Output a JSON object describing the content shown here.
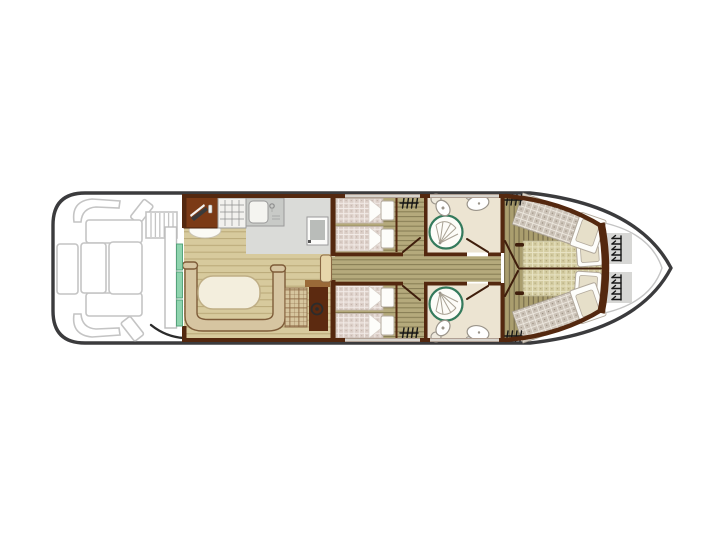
{
  "colors": {
    "hull": "#3b3b3d",
    "deck-stroke": "#c4c4c4",
    "wall": "#54280f",
    "door-leaf": "#3f1e0c",
    "window": "#d8d4cd",
    "counter": "#7b3a16",
    "counter-edge": "#451f0a",
    "floor-saloon": "#d7ca9d",
    "floor-saloon-line": "#b9a877",
    "floor-cabin": "#b5aa7c",
    "floor-cabin-line": "#857b52",
    "floor-bow": "#aa9e6e",
    "floor-bow-line": "#6f6547",
    "floor-kitchen": "#dadbd8",
    "floor-bath": "#ece4d2",
    "bed-a": "#dccfc8",
    "bed-a-line": "#f3ece8",
    "bed-a-dot": "#b9a9a0",
    "bed-b": "#ccc3b8",
    "bed-b-line": "#ece7de",
    "bed-b-dot": "#938878",
    "bed-c": "#d4cca1",
    "bed-c-line": "#e9e4c5",
    "bed-c-dot": "#9e9468",
    "pillow": "#fdfdfa",
    "pillow-stroke": "#b2a99c",
    "pillow-beige": "#e6dfc9",
    "bench": "#d6c5a1",
    "bench-stroke": "#7e5c39",
    "table": "#f3eedd",
    "table-stroke": "#bfae85",
    "green-door": "#8fd4ae",
    "green-door-stroke": "#4d9e75",
    "slide-door": "#e7d6aa",
    "console": "#5c2a10",
    "console-shelf": "#9a6a38",
    "plaid": "#d6c59e",
    "plaid-line": "#8a6844",
    "fixture": "#9a948a",
    "shower-ring": "#347a5c",
    "steps": "#d7d7d5",
    "symbol": "#161616",
    "appliance": "#c8cac7",
    "stove": "#f2f1ee",
    "fridge-inner": "#b9bcb9"
  },
  "floorplan": {
    "view": "top-down boat deck plan, bow pointing right",
    "areas": [
      {
        "id": "aft-deck",
        "features": [
          "corner-bench-port",
          "corner-bench-starboard",
          "deck-cushion-port",
          "deck-cushion-starboard",
          "deck-bench-port",
          "deck-bench-starboard",
          "side-bench",
          "deck-table",
          "deck-table-small",
          "boarding-stairs"
        ]
      },
      {
        "id": "saloon",
        "features": [
          "galley-counter",
          "cutting-board",
          "knife-icon",
          "stove-icon",
          "sink-icon",
          "fridge",
          "dinette-table",
          "dinette-bench",
          "helm-seat",
          "steering-console",
          "steering-wheel-icon",
          "entry-door",
          "green-door-panels"
        ]
      },
      {
        "id": "cabin-port",
        "features": [
          "single-berth",
          "single-berth",
          "pillow",
          "pillow",
          "radiator-icon",
          "cabin-door"
        ]
      },
      {
        "id": "cabin-starboard",
        "features": [
          "single-berth",
          "single-berth",
          "pillow",
          "pillow",
          "radiator-icon",
          "cabin-door"
        ]
      },
      {
        "id": "bathroom-port",
        "features": [
          "shower",
          "toilet",
          "washbasin",
          "bathroom-door"
        ]
      },
      {
        "id": "bathroom-starboard",
        "features": [
          "shower",
          "toilet",
          "washbasin",
          "bathroom-door"
        ]
      },
      {
        "id": "bow-cabin",
        "features": [
          "double-berth-split",
          "pillow",
          "pillow",
          "angled-berth-port",
          "angled-berth-starboard",
          "radiator-icon",
          "radiator-icon",
          "cabin-door"
        ]
      },
      {
        "id": "bow-deck",
        "features": [
          "step-locker",
          "step-locker",
          "ladder-icon",
          "ladder-icon"
        ]
      },
      {
        "id": "corridor",
        "features": [
          "sliding-door"
        ]
      }
    ]
  }
}
